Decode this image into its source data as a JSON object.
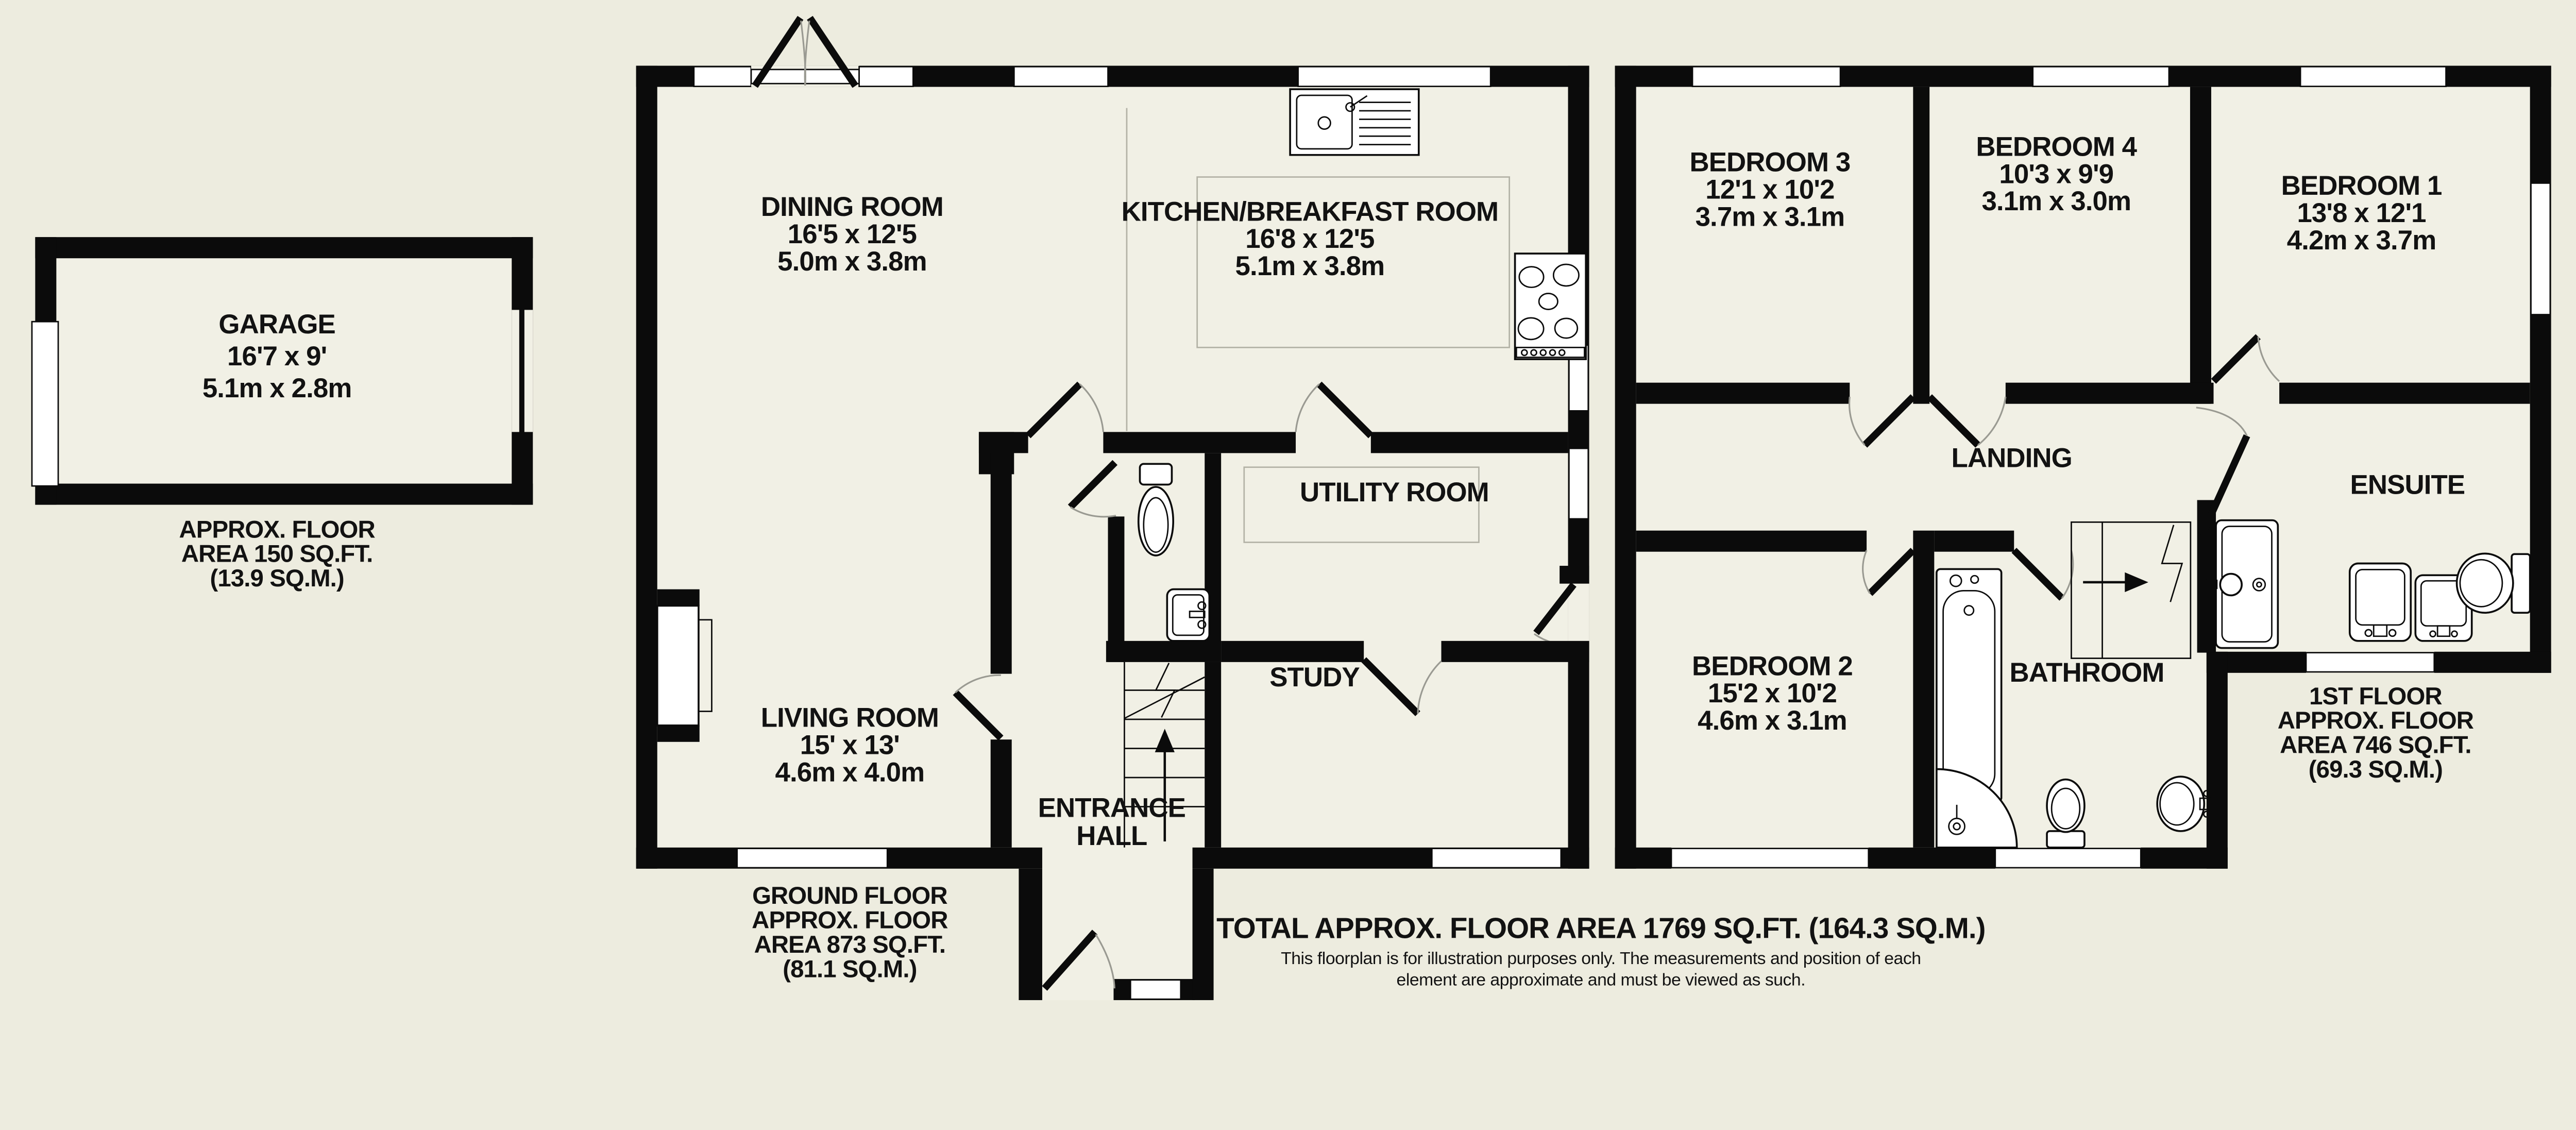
{
  "colors": {
    "background": "#edecdf",
    "floor": "#f1f0e5",
    "wall": "#0b0b0b",
    "window": "#ffffff",
    "door_arc": "#9a9a92",
    "counter_line": "#b3b2a6"
  },
  "plan": {
    "garage": {
      "name": "GARAGE",
      "imperial": "16'7 x 9'",
      "metric": "5.1m x 2.8m",
      "area_note": [
        "APPROX. FLOOR",
        "AREA 150 SQ.FT.",
        "(13.9 SQ.M.)"
      ]
    },
    "ground_floor": {
      "rooms": {
        "dining_room": {
          "name": "DINING ROOM",
          "imperial": "16'5 x 12'5",
          "metric": "5.0m x 3.8m"
        },
        "kitchen": {
          "name": "KITCHEN/BREAKFAST ROOM",
          "imperial": "16'8 x 12'5",
          "metric": "5.1m x 3.8m"
        },
        "living_room": {
          "name": "LIVING ROOM",
          "imperial": "15' x 13'",
          "metric": "4.6m x 4.0m"
        },
        "entrance_hall": {
          "line1": "ENTRANCE",
          "line2": "HALL"
        },
        "study": {
          "name": "STUDY"
        },
        "utility_room": {
          "name": "UTILITY ROOM"
        }
      },
      "area_note": [
        "GROUND FLOOR",
        "APPROX. FLOOR",
        "AREA 873 SQ.FT.",
        "(81.1 SQ.M.)"
      ]
    },
    "first_floor": {
      "rooms": {
        "bedroom1": {
          "name": "BEDROOM 1",
          "imperial": "13'8 x 12'1",
          "metric": "4.2m x 3.7m"
        },
        "bedroom2": {
          "name": "BEDROOM 2",
          "imperial": "15'2 x 10'2",
          "metric": "4.6m x 3.1m"
        },
        "bedroom3": {
          "name": "BEDROOM 3",
          "imperial": "12'1 x 10'2",
          "metric": "3.7m x 3.1m"
        },
        "bedroom4": {
          "name": "BEDROOM 4",
          "imperial": "10'3 x 9'9",
          "metric": "3.1m x 3.0m"
        },
        "landing": {
          "name": "LANDING"
        },
        "bathroom": {
          "name": "BATHROOM"
        },
        "ensuite": {
          "name": "ENSUITE"
        }
      },
      "area_note": [
        "1ST FLOOR",
        "APPROX. FLOOR",
        "AREA 746 SQ.FT.",
        "(69.3 SQ.M.)"
      ]
    },
    "footer": {
      "total": "TOTAL APPROX. FLOOR AREA 1769 SQ.FT. (164.3 SQ.M.)",
      "disclaimer": [
        "This floorplan is for illustration purposes only. The measurements and position of each",
        "element are approximate and must be viewed as such."
      ]
    }
  }
}
